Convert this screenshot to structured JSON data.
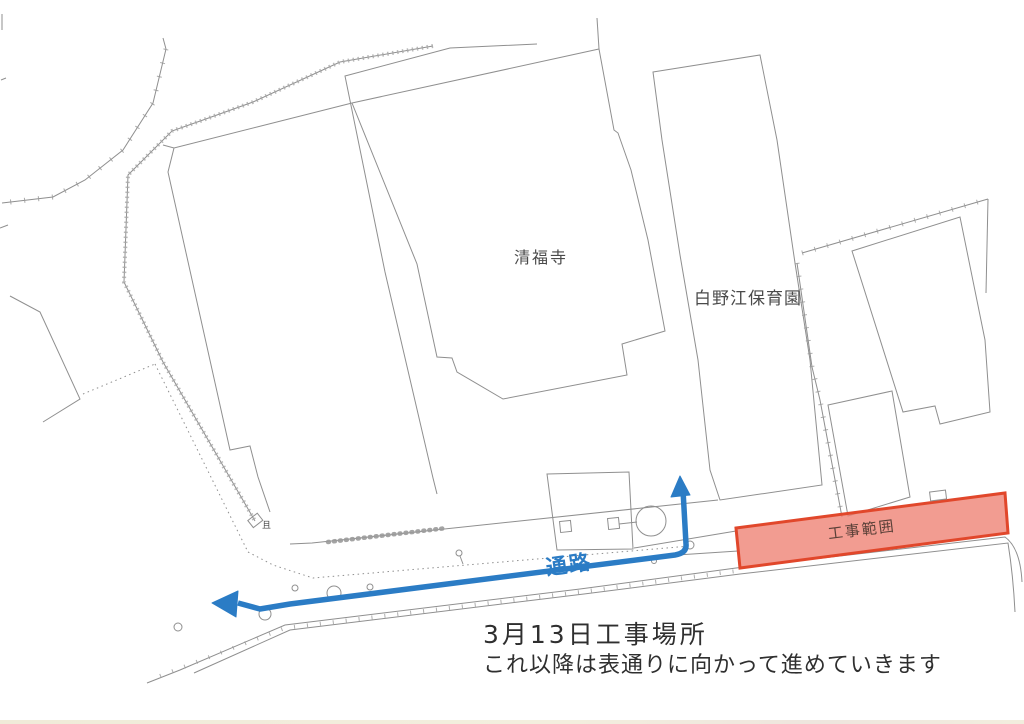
{
  "document": {
    "type": "scanned construction site map",
    "labels": {
      "temple": "清福寺",
      "nursery": "白野江保育園",
      "construction_zone": "工事範囲",
      "passage": "通路",
      "shed_glyph": "且"
    },
    "notes": {
      "line1": "3月13日工事場所",
      "line2": "これ以降は表通りに向かって進めていきます"
    },
    "colors": {
      "route_blue": "#2b7cc5",
      "zone_fill": "#ee8072",
      "zone_border": "#e1472b",
      "map_line_gray": "#8f8f8f",
      "text_dark": "#2f2f2f"
    }
  }
}
